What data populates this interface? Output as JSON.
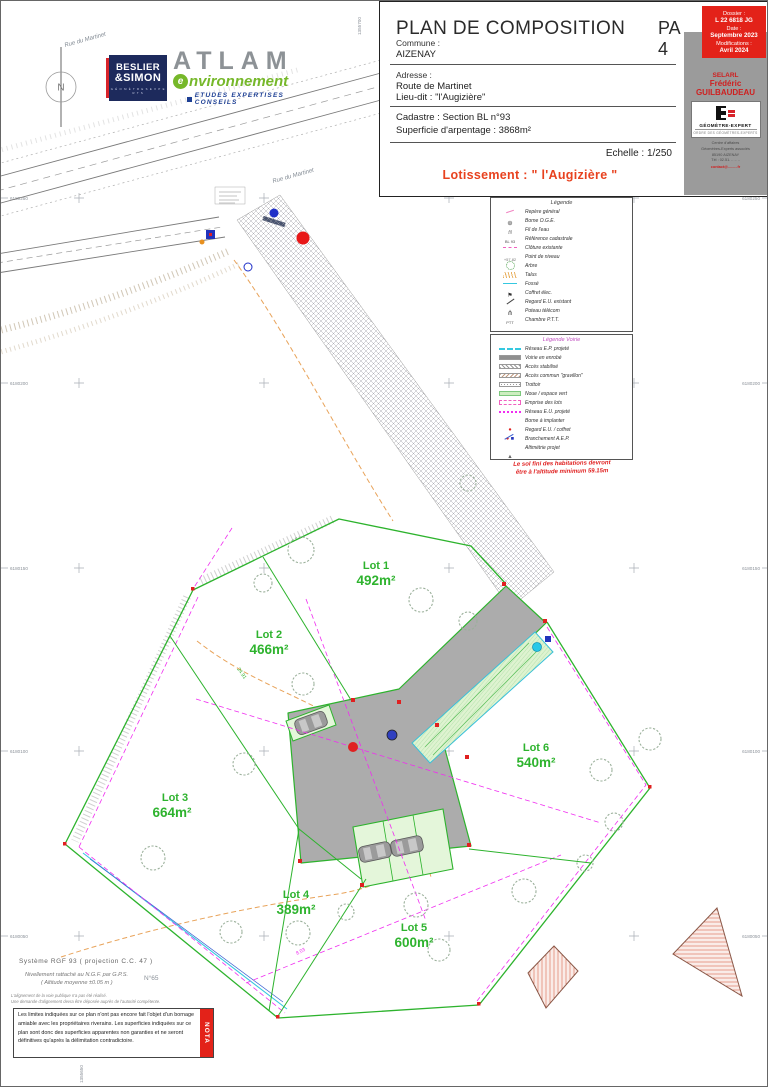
{
  "colors": {
    "lot_green": "#2eb32e",
    "boundary_green": "#2db32d",
    "magenta": "#f02df0",
    "cyan": "#35c8e0",
    "road_gray": "#acacac",
    "light_green": "#def3d0",
    "accent_red": "#e32219",
    "orange": "#e8a35a",
    "navy": "#1d2a5c",
    "atlam_green": "#76b82a"
  },
  "north": {
    "label": "N"
  },
  "street": {
    "name": "Rue du Martinet"
  },
  "logos": {
    "beslier": {
      "line1": "BESLIER",
      "line2": "&SIMON",
      "sub": "G É O M È T R E S  E X P E R T S"
    },
    "atlam": {
      "name": "ATLAM",
      "e": "e",
      "sub": "nvironnement",
      "tagline": "ETUDES EXPERTISES CONSEILS"
    }
  },
  "title_block": {
    "title": "PLAN DE COMPOSITION",
    "sheet": "PA 4",
    "dossier": {
      "l1": "Dossier :",
      "v1": "L 22 6818 JG",
      "l2": "Date :",
      "v2": "Septembre 2023",
      "l3": "Modifications :",
      "v3": "Avril 2024"
    },
    "commune_label": "Commune :",
    "commune": "AIZENAY",
    "adresse_label": "Adresse :",
    "adresse1": "Route de Martinet",
    "adresse2": "Lieu-dit : \"l'Augizière\"",
    "cadastre": "Cadastre : Section BL n°93",
    "superficie": "Superficie d'arpentage : 3868m²",
    "echelle": "Echelle : 1/250",
    "lotissement": "Lotissement : \" l'Augizière \"",
    "firm": {
      "l1": "SELARL",
      "l2": "Frédéric",
      "l3": "GUILBAUDEAU",
      "brand": "GÉOMÈTRE-EXPERT",
      "brand_sub": "ORDRE DES GÉOMÈTRES-EXPERTS",
      "addr": [
        "Centre d'affaires",
        "Géomètres-Experts associés",
        "85190 AIZENAY",
        "Tél : 02.51. .. .. .."
      ],
      "email": "contact@.........fr"
    }
  },
  "legend1": {
    "title": "Légende",
    "items": [
      {
        "sym": "sym-pink-tick",
        "label": "Repère général"
      },
      {
        "sym": "sym-borne",
        "label": "Borne O.G.E."
      },
      {
        "sym": "sym-script",
        "label": "Fil de l'eau"
      },
      {
        "sym": "sym-ref",
        "label": "Référence cadastrale"
      },
      {
        "sym": "sym-pink-dash",
        "label": "Clôture existante"
      },
      {
        "sym": "sym-level",
        "label": "Point de niveau"
      },
      {
        "sym": "sym-tree",
        "label": "Arbre"
      },
      {
        "sym": "sym-talus",
        "label": "Talus"
      },
      {
        "sym": "sym-fosse",
        "label": "Fossé"
      },
      {
        "sym": "sym-flag",
        "label": "Coffret élec."
      },
      {
        "sym": "sym-slash",
        "label": "Regard E.U. existant"
      },
      {
        "sym": "sym-pole",
        "label": "Poteau télécom"
      },
      {
        "sym": "sym-ptt",
        "label": "Chambre P.T.T."
      }
    ]
  },
  "legend2": {
    "title": "Légende Voirie",
    "items": [
      {
        "sym": "sw-cyan-dash",
        "label": "Réseau E.P. projeté"
      },
      {
        "sym": "sw-enrobe",
        "label": "Voirie en enrobé"
      },
      {
        "sym": "sw-hatch-gray",
        "label": "Accès stabilisé"
      },
      {
        "sym": "sw-hatch-brown",
        "label": "Accès commun \"gravillon\""
      },
      {
        "sym": "sw-dotted",
        "label": "Trottoir"
      },
      {
        "sym": "sw-green",
        "label": "Noue / espace vert"
      },
      {
        "sym": "sw-lot",
        "label": "Emprise des lots"
      },
      {
        "sym": "sw-eu",
        "label": "Réseau E.U. projeté"
      },
      {
        "sym": "sw-borne-red",
        "label": "Borne à implanter"
      },
      {
        "sym": "sw-regard",
        "label": "Regard E.U. / coffret"
      },
      {
        "sym": "sw-aep",
        "label": "Branchement A.E.P."
      },
      {
        "sym": "sw-alti",
        "label": "Altimétrie projet"
      }
    ],
    "note1": "Le sol fini des habitations devront",
    "note2": "être à l'altitude minimum 59.15m"
  },
  "lots": [
    {
      "name": "Lot 1",
      "area": "492m²"
    },
    {
      "name": "Lot 2",
      "area": "466m²"
    },
    {
      "name": "Lot 3",
      "area": "664m²"
    },
    {
      "name": "Lot 4",
      "area": "389m²"
    },
    {
      "name": "Lot 5",
      "area": "600m²"
    },
    {
      "name": "Lot 6",
      "area": "540m²"
    }
  ],
  "grid": {
    "left": [
      "6180250",
      "6180200",
      "6180150",
      "6180100",
      "6180050"
    ],
    "right": [
      "6180250",
      "6180200",
      "6180150",
      "6180100",
      "6180050"
    ],
    "top": "1355700",
    "bottom": "1355650"
  },
  "measurements": [
    "24.91",
    "8.03"
  ],
  "notes": {
    "sys": "Système RGF 93 ( projection C.C. 47 )",
    "niv1": "Nivellement rattaché au N.G.F. par G.P.S.",
    "niv2": "( Altitude moyenne ±0.05 m )",
    "micro1": "L'alignement de la voie publique n'a pas été réalisé.",
    "micro2": "Une demande d'alignement devra être déposée auprès de l'autorité compétente.",
    "parcel": "N°65",
    "nota_label": "NOTA",
    "nota_text": "Les limites indiquées sur ce plan n'ont pas encore fait l'objet d'un bornage amiable avec les propriétaires riverains. Les superficies indiquées sur ce plan sont donc des superficies apparentes non garanties et ne seront définitives qu'après la délimitation contradictoire."
  }
}
